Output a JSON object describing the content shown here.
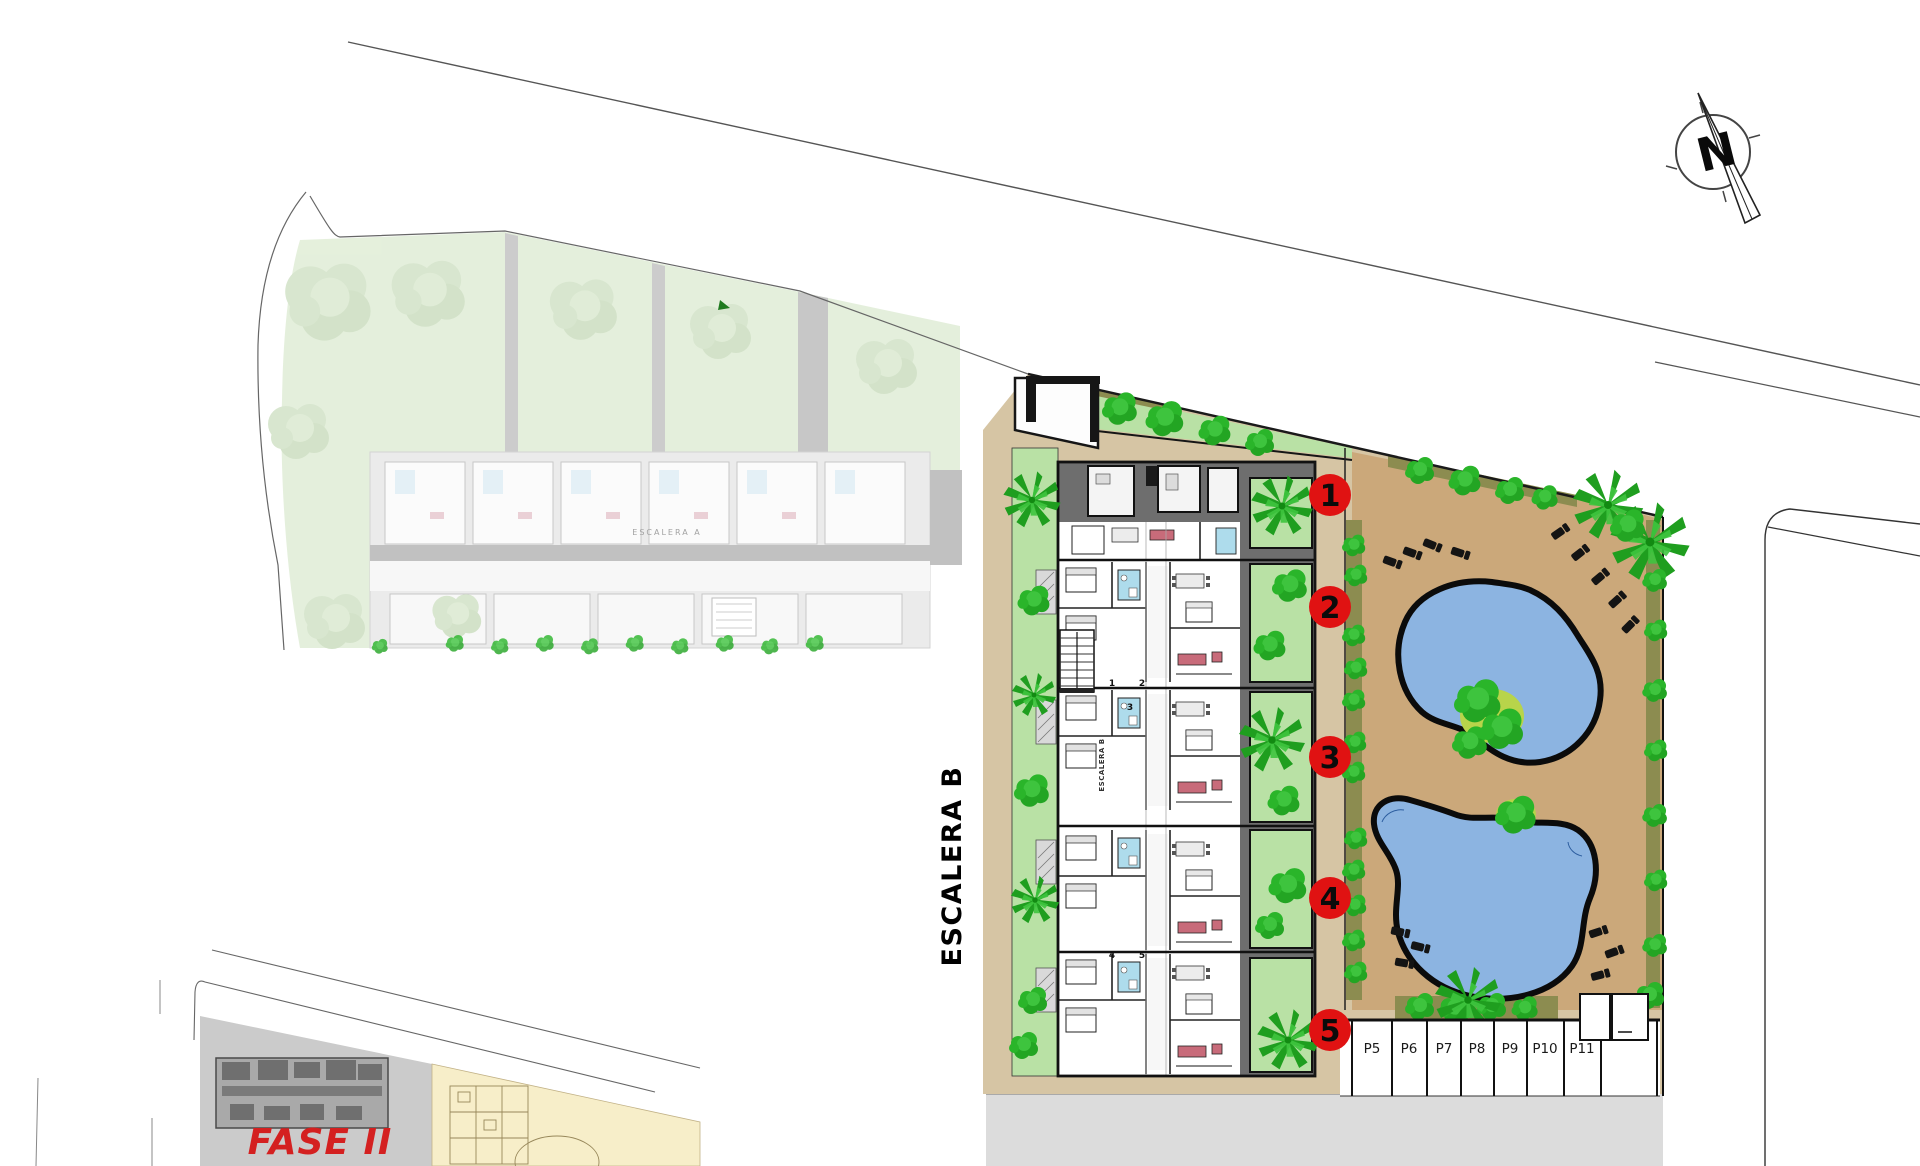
{
  "plan": {
    "labels": {
      "stairwell_b": "ESCALERA B",
      "stairwell_b_inner": "ESCALERA B",
      "stairwell_a": "ESCALERA A",
      "phase": "FASE II",
      "compass_north": "N"
    },
    "unit_markers": [
      {
        "number": "1"
      },
      {
        "number": "2"
      },
      {
        "number": "3"
      },
      {
        "number": "4"
      },
      {
        "number": "5"
      }
    ],
    "door_numbers": [
      "1",
      "2",
      "3",
      "4",
      "5"
    ],
    "parking_spaces": [
      {
        "label": "P5"
      },
      {
        "label": "P6"
      },
      {
        "label": "P7"
      },
      {
        "label": "P8"
      },
      {
        "label": "P9"
      },
      {
        "label": "P10"
      },
      {
        "label": "P11"
      }
    ],
    "colors": {
      "marker_red": "#e01212",
      "phase_red": "#d42020",
      "pool_blue": "#8cb4e1",
      "deck_tan": "#cba87a",
      "path_tan": "#d6c5a4",
      "garden_green": "#b9e1a5",
      "tree_green": "#2ab52a",
      "hedge_olive": "#8c8c50",
      "road_gray": "#dcdcdc",
      "roof_gray": "#6e6e6e",
      "bath_blue": "#aedcec",
      "sofa_pink": "#c86b7a",
      "faded_site_green": "#cfe3c0",
      "inset_gray": "#cbcbcb",
      "inset_cream": "#f7eec9"
    }
  }
}
